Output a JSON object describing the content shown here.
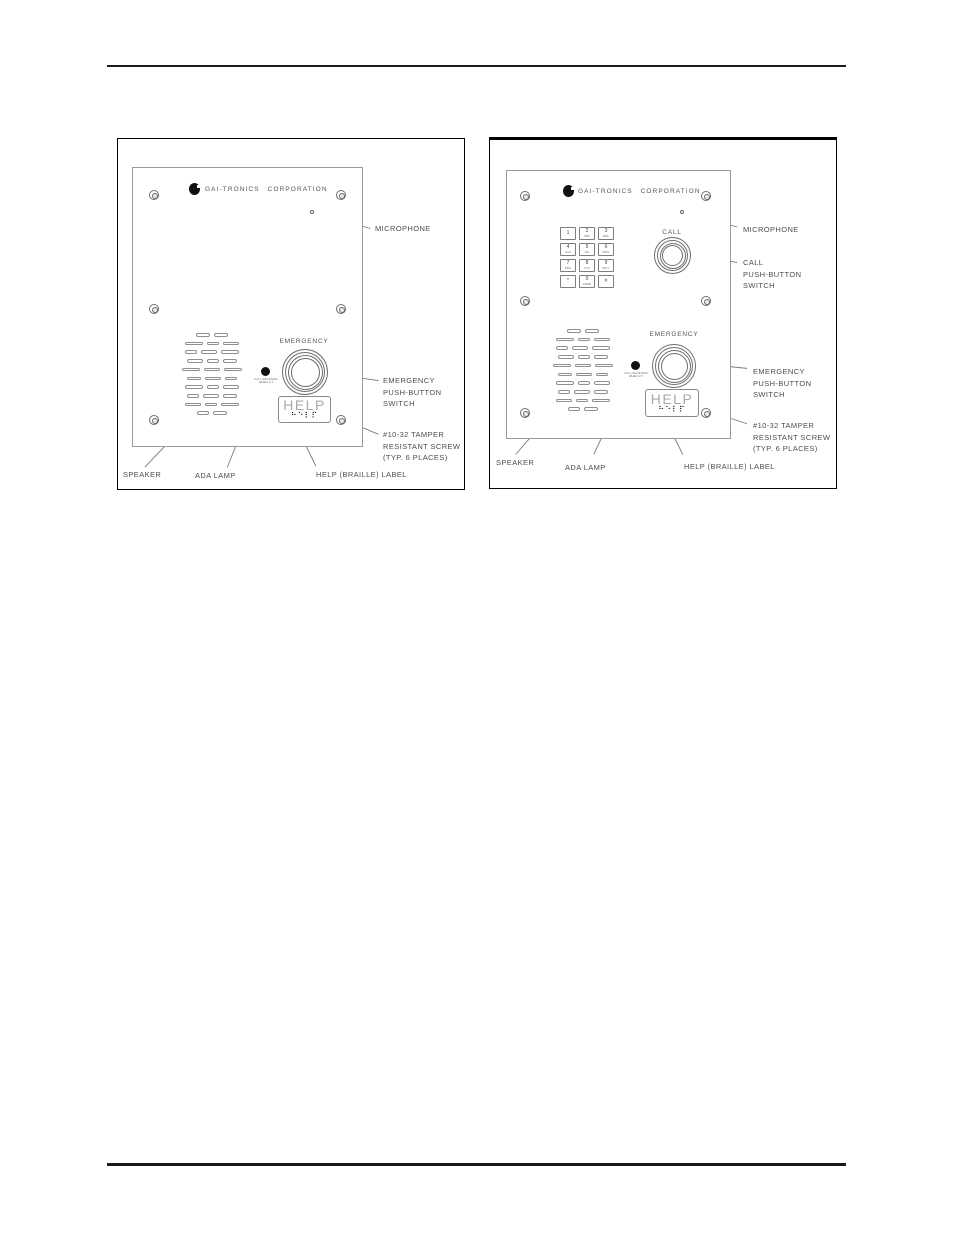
{
  "left_figure": {
    "brand": "GAI-TRONICS CORPORATION",
    "panel": {
      "emergency": "EMERGENCY",
      "help": "HELP",
      "braille": "⠓⠑⠇⠏",
      "ada_caption_1": "CALL RECEIVED",
      "ada_caption_2": "WHEN LIT"
    },
    "callouts": {
      "microphone": "MICROPHONE",
      "emg_1": "EMERGENCY",
      "emg_2": "PUSH-BUTTON",
      "emg_3": "SWITCH",
      "screw_1": "#10-32 TAMPER",
      "screw_2": "RESISTANT SCREW",
      "screw_3": "(TYP. 6 PLACES)",
      "speaker": "SPEAKER",
      "ada": "ADA LAMP",
      "help": "HELP (BRAILLE) LABEL"
    }
  },
  "right_figure": {
    "brand": "GAI-TRONICS CORPORATION",
    "panel": {
      "call": "CALL",
      "emergency": "EMERGENCY",
      "help": "HELP",
      "braille": "⠓⠑⠇⠏",
      "ada_caption_1": "CALL RECEIVED",
      "ada_caption_2": "WHEN LIT"
    },
    "keypad": {
      "keys": [
        {
          "d": "1",
          "s": ""
        },
        {
          "d": "2",
          "s": "ABC"
        },
        {
          "d": "3",
          "s": "DEF"
        },
        {
          "d": "4",
          "s": "GHI"
        },
        {
          "d": "5",
          "s": "JKL"
        },
        {
          "d": "6",
          "s": "MNO"
        },
        {
          "d": "7",
          "s": "PRS"
        },
        {
          "d": "8",
          "s": "TUV"
        },
        {
          "d": "9",
          "s": "WXY"
        },
        {
          "d": "*",
          "s": ""
        },
        {
          "d": "0",
          "s": "OPER"
        },
        {
          "d": "#",
          "s": ""
        }
      ]
    },
    "callouts": {
      "microphone": "MICROPHONE",
      "call_1": "CALL",
      "call_2": "PUSH-BUTTON",
      "call_3": "SWITCH",
      "emg_1": "EMERGENCY",
      "emg_2": "PUSH-BUTTON",
      "emg_3": "SWITCH",
      "screw_1": "#10-32 TAMPER",
      "screw_2": "RESISTANT SCREW",
      "screw_3": "(TYP. 6 PLACES)",
      "speaker": "SPEAKER",
      "ada": "ADA LAMP",
      "help": "HELP (BRAILLE) LABEL"
    }
  }
}
